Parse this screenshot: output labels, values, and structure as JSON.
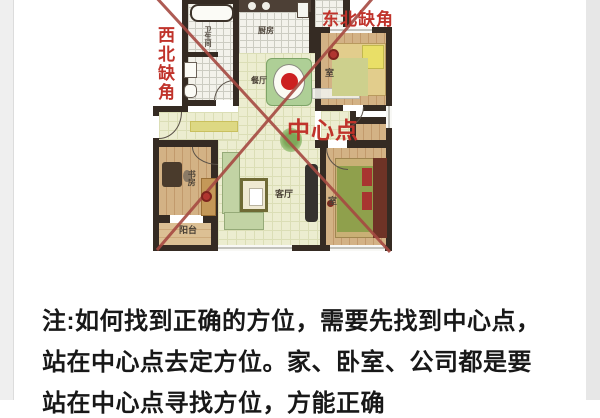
{
  "page": {
    "background": "#ffffff",
    "left_strip_color": "#efefef",
    "right_strip_color": "#e7e7e7"
  },
  "floorplan": {
    "annotations": {
      "northwest_missing_corner": "西北缺角",
      "northeast_missing_corner": "东北缺角",
      "center_point": "中心点"
    },
    "rooms": {
      "bathroom": "卫生间",
      "kitchen": "厨房",
      "dining": "餐厅",
      "bedroom_top": "室",
      "study": "书房",
      "balcony": "阳台",
      "living": "客厅",
      "bedroom_bottom": "室"
    },
    "colors": {
      "wall": "#352b23",
      "floor_pale": "#ecedd0",
      "floor_tan": "#d3b285",
      "annotation_red": "#c0332b",
      "cross_line_red": "#a64a42",
      "table_bowl_red": "#cc2020"
    }
  },
  "note": {
    "line1": "注:如何找到正确的方位，需要先找到中心点，",
    "line2": "站在中心点去定方位。家、卧室、公司都是要",
    "line3": "站在中心点寻找方位，方能正确"
  }
}
